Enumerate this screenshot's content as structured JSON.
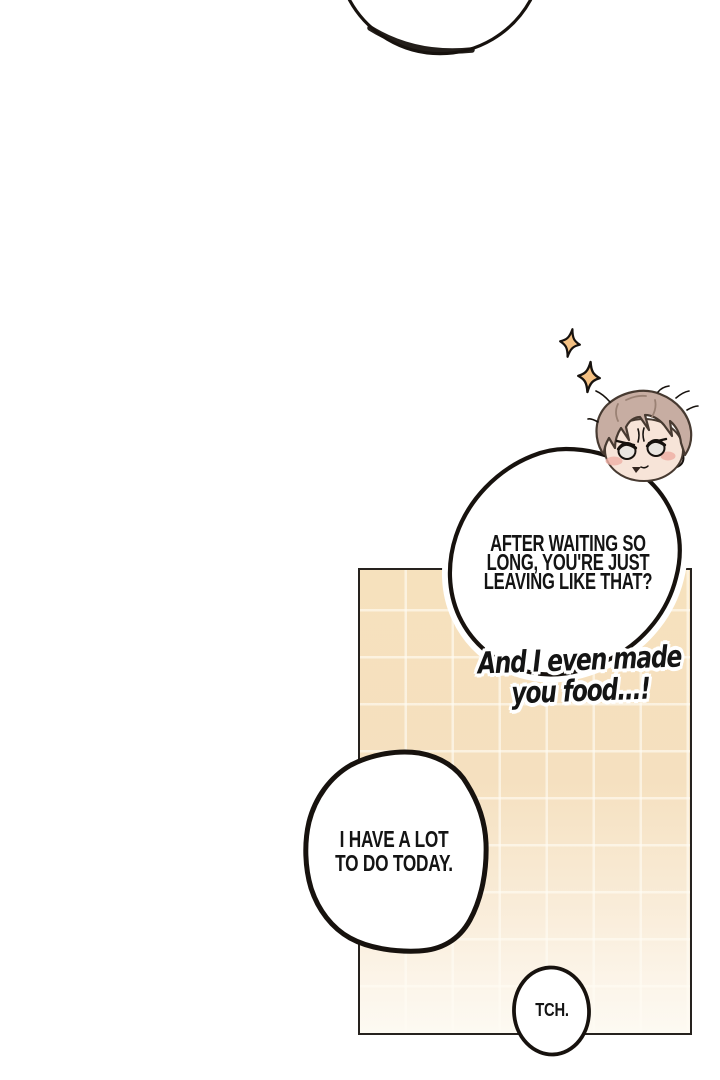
{
  "speech": {
    "main": {
      "lines": [
        "AFTER WAITING SO",
        "LONG, YOU'RE JUST",
        "LEAVING LIKE THAT?"
      ]
    },
    "hand": {
      "lines": [
        "And I even made",
        "you food...!"
      ]
    },
    "left": {
      "lines": [
        "I HAVE A LOT",
        "TO DO TODAY."
      ]
    },
    "sfx": {
      "text": "TCH."
    }
  },
  "icons": {
    "sparkle-icon": "four-point-star"
  },
  "colors": {
    "line": "#17120e",
    "text": "#141414",
    "tile-top": "#f6e1bd",
    "tile-bottom": "#fdfaf2",
    "grout": "rgba(255,252,244,0.62)",
    "sparkle-fill": "#f5c183",
    "hair": "#c7ada2",
    "hair-line": "#473a31",
    "hair-strand": "#9a8174",
    "skin": "#f7e4d8",
    "blush": "#efb0a6",
    "eye-white": "#e9e5e0",
    "bubble-fill": "#ffffff"
  }
}
